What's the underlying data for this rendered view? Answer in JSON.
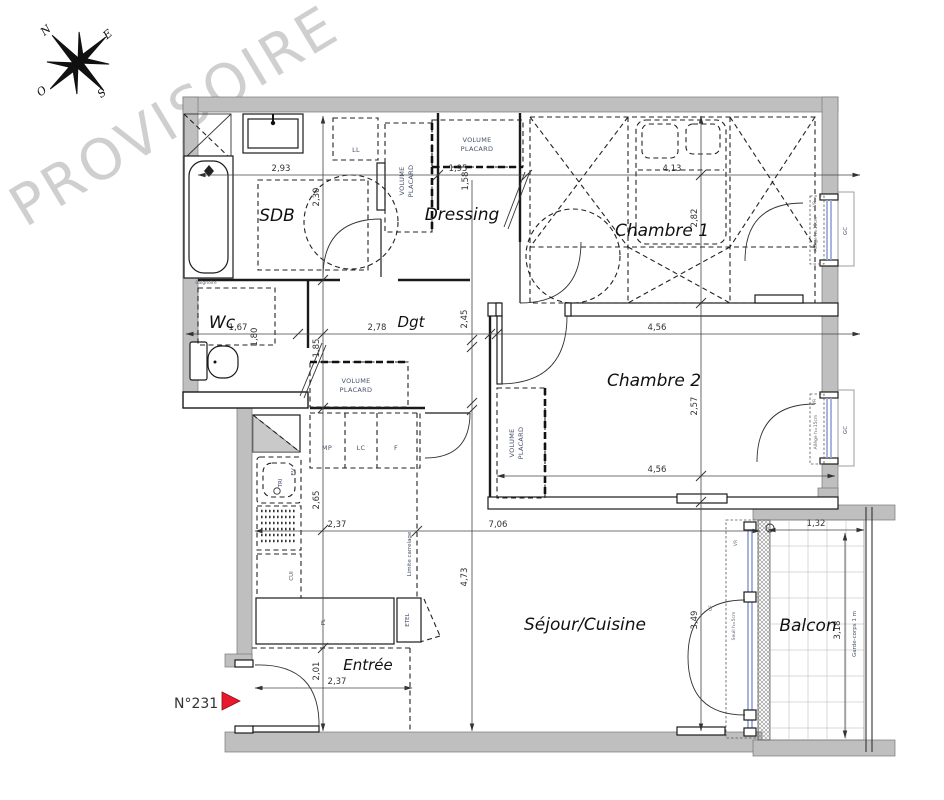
{
  "watermark": "PROVISOIRE",
  "plan": {
    "unit_label": "N°231"
  },
  "compass": {
    "n": "N",
    "e": "E",
    "s": "S",
    "w": "O"
  },
  "rooms": {
    "sdb": "SDB",
    "dressing": "Dressing",
    "chambre1": "Chambre 1",
    "wc": "Wc",
    "dgt": "Dgt",
    "chambre2": "Chambre 2",
    "sejour": "Séjour/Cuisine",
    "entree": "Entrée",
    "balcon": "Balcon"
  },
  "dims": {
    "d293": "2,93",
    "d230": "2,30",
    "d195": "1,95",
    "d158": "1,58",
    "d413": "4,13",
    "d282": "2,82",
    "d167": "1,67",
    "d180": "1,80",
    "d278": "2,78",
    "d185": "1,85",
    "d245": "2,45",
    "d456": "4,56",
    "d257": "2,57",
    "d237": "2,37",
    "d265": "2,65",
    "d706": "7,06",
    "d473": "4,73",
    "d201": "2,01",
    "d349": "3,49",
    "d132": "1,32",
    "d318": "3,18"
  },
  "fixtures": {
    "ll": "LL",
    "volume": "VOLUME",
    "placard": "PLACARD",
    "mp": "MP",
    "lc": "LC",
    "f": "F",
    "ev": "EV",
    "tri": "TRI",
    "cui": "CUI",
    "pl": "PL",
    "etel": "ETEL",
    "baignoire": "Baignoire"
  },
  "openings": {
    "vr": "VR",
    "cf": "CF",
    "gc": "GC",
    "allege": "Allège h=15cm",
    "seuil": "Seuil h=5cm",
    "garde_corps": "Garde-corps 1 m"
  },
  "annotations": {
    "limite_carrelage": "Limite carrelage"
  }
}
